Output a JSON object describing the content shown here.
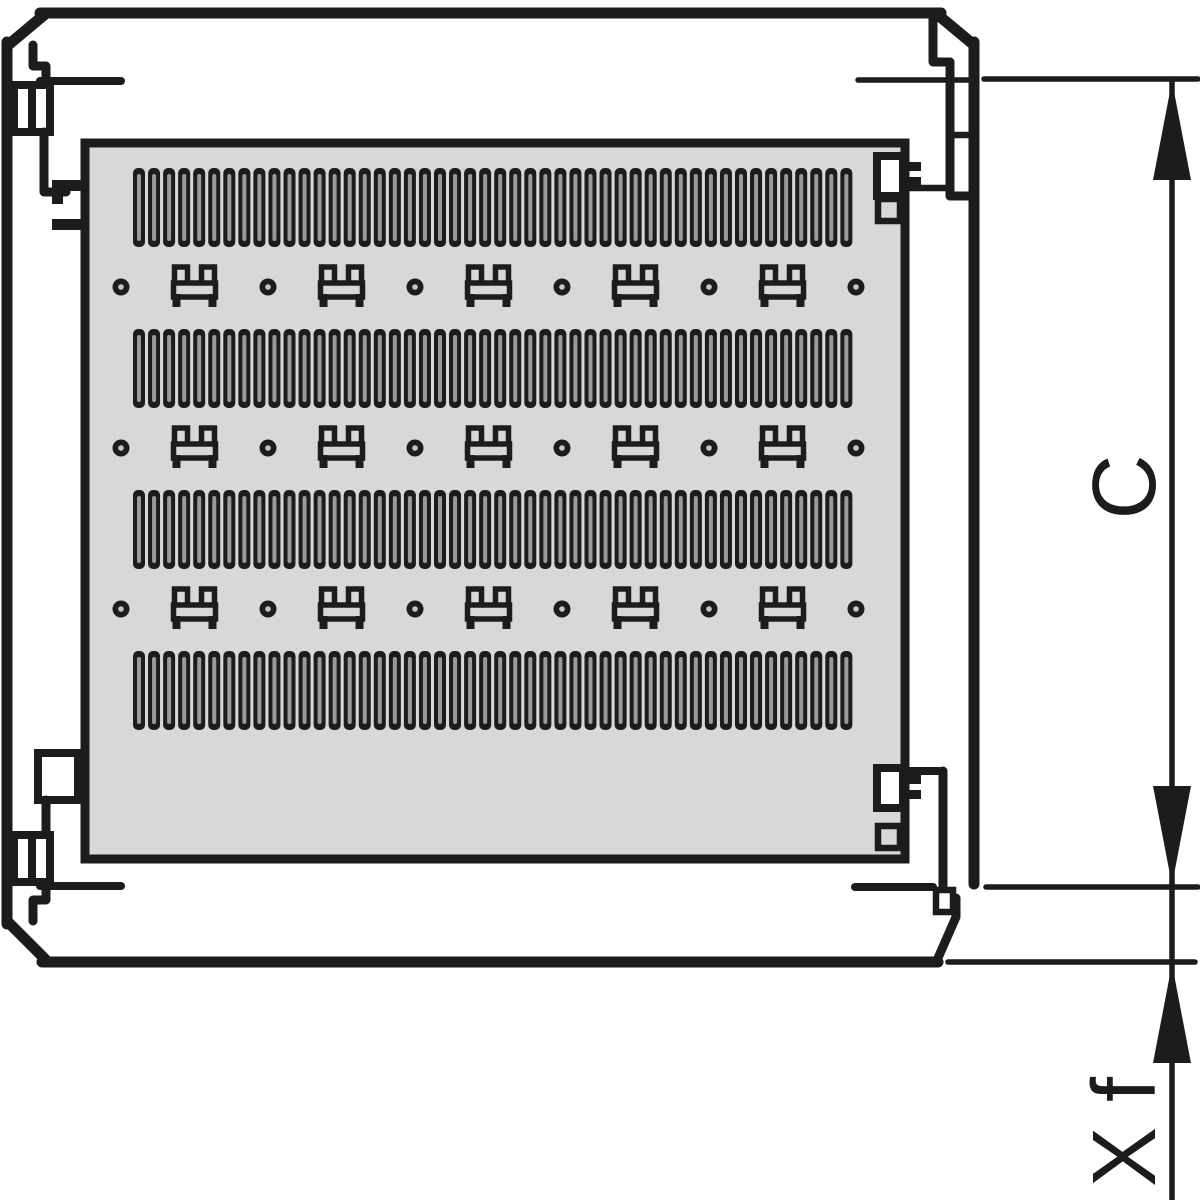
{
  "diagram": {
    "type": "technical-drawing",
    "description": "Rack cabinet plan view with perforated mounting plate, ventilation slot bands, cable-tie brackets and dimension annotations",
    "labels": {
      "c": "C",
      "xf": "X f"
    },
    "colors": {
      "line": "#1c1c1c",
      "panel_fill": "#d8d8d8",
      "slot_slit": "#9a9a9a",
      "background": "#ffffff"
    },
    "panel": {
      "slot_bands": {
        "count": 4,
        "slots_per_band": 48
      },
      "tie_rows": {
        "count": 3,
        "brackets_per_row": 5,
        "holes_per_row": 6
      }
    }
  }
}
